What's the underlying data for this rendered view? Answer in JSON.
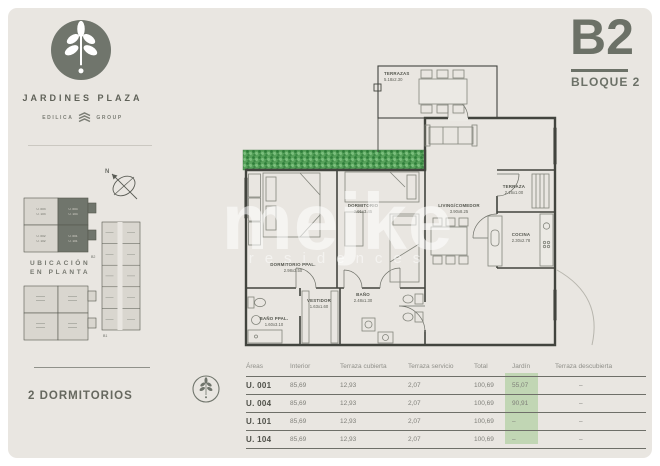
{
  "brand": {
    "name": "JARDINES PLAZA",
    "group_left": "EDILICA",
    "group_right": "GROUP"
  },
  "unit": {
    "code": "B2",
    "block_label": "BLOQUE 2"
  },
  "sidebar": {
    "location_line1": "UBICACIÓN",
    "location_line2": "EN PLANTA",
    "compass_n": "N",
    "block_mark_plan": "B2",
    "block_mark_tower": "B1",
    "plan_units": [
      {
        "line1": "U. 003",
        "line2": "U. 103",
        "highlighted": false
      },
      {
        "line1": "U. 004",
        "line2": "U. 104",
        "highlighted": true
      },
      {
        "line1": "U. 002",
        "line2": "U. 102",
        "highlighted": false
      },
      {
        "line1": "U. 001",
        "line2": "U. 101",
        "highlighted": true
      }
    ]
  },
  "summary": {
    "label": "2 DORMITORIOS"
  },
  "floorplan": {
    "rooms": {
      "terrazas": {
        "name": "TERRAZAS",
        "dims": "5.18x2.30"
      },
      "dormitorio_ppal": {
        "name": "DORMITORIO PPAL.",
        "dims": "2.98x3.50"
      },
      "dormitorio": {
        "name": "DORMITORIO",
        "dims": "2.91x3.45"
      },
      "living": {
        "name": "LIVING/COMEDOR",
        "dims": "3.90x8.25"
      },
      "terraza": {
        "name": "TERRAZA",
        "dims": "2.16x1.00"
      },
      "cocina": {
        "name": "COCINA",
        "dims": "2.30x2.78"
      },
      "bano_ppal": {
        "name": "BAÑO PPAL.",
        "dims": "1.60x3.10"
      },
      "vestidor": {
        "name": "VESTIDOR",
        "dims": "1.63x1.60"
      },
      "bano": {
        "name": "BAÑO",
        "dims": "2.48x1.30"
      }
    }
  },
  "watermark": {
    "text": "mejke",
    "subtitle": "residences"
  },
  "areas_table": {
    "headers": [
      "Áreas",
      "Interior",
      "Terraza cubierta",
      "Terraza servicio",
      "Total",
      "Jardín",
      "Terraza descubierta"
    ],
    "rows": [
      {
        "unit": "U. 001",
        "interior": "85,69",
        "terraza_cubierta": "12,93",
        "terraza_servicio": "2,07",
        "total": "100,69",
        "jardin": "55,07",
        "terraza_descubierta": "–"
      },
      {
        "unit": "U. 004",
        "interior": "85,69",
        "terraza_cubierta": "12,93",
        "terraza_servicio": "2,07",
        "total": "100,69",
        "jardin": "90,91",
        "terraza_descubierta": "–"
      },
      {
        "unit": "U. 101",
        "interior": "85,69",
        "terraza_cubierta": "12,93",
        "terraza_servicio": "2,07",
        "total": "100,69",
        "jardin": "–",
        "terraza_descubierta": "–"
      },
      {
        "unit": "U. 104",
        "interior": "85,69",
        "terraza_cubierta": "12,93",
        "terraza_servicio": "2,07",
        "total": "100,69",
        "jardin": "–",
        "terraza_descubierta": "–"
      }
    ],
    "jardin_highlight_color": "#b7d2a9"
  },
  "colors": {
    "card_bg": "#e9e6e1",
    "accent": "#6c7167",
    "wall": "#42443e",
    "hedge_green": "#4f9c55"
  }
}
